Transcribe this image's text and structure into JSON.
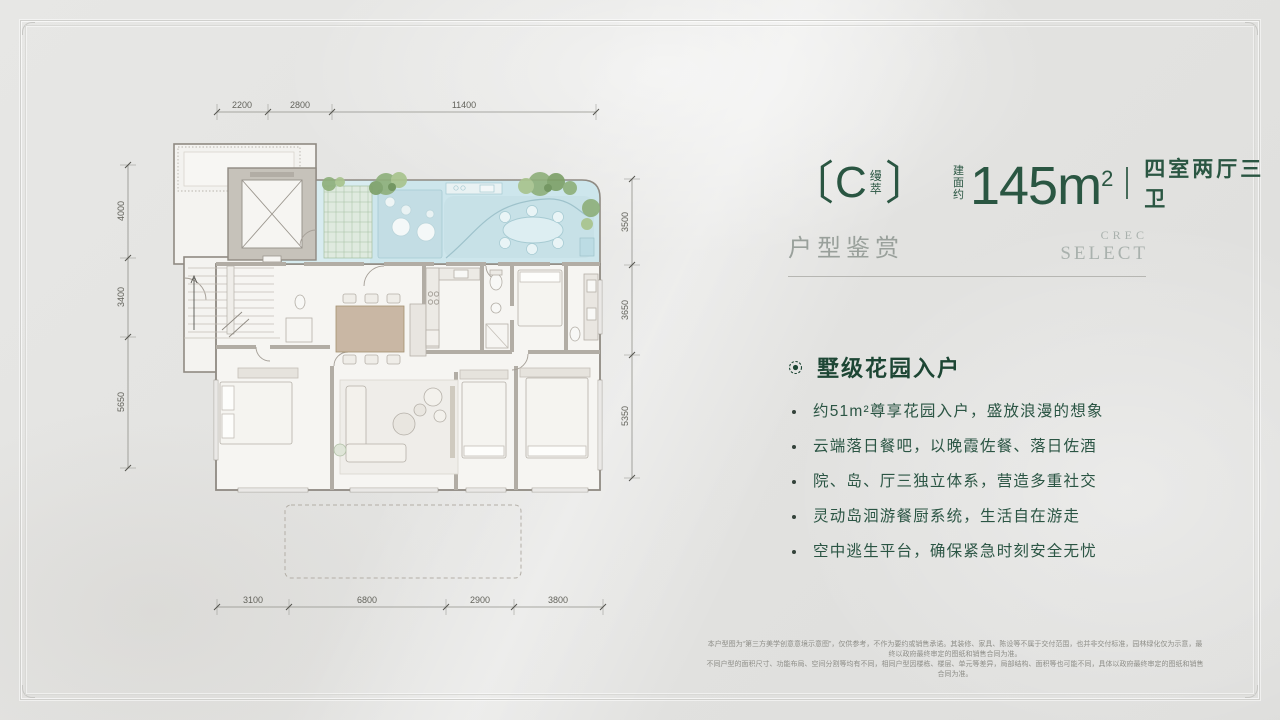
{
  "header": {
    "bracket_open": "〔",
    "unit_letter": "C",
    "unit_name": "缦萃",
    "bracket_close": "〕",
    "area_prefix": "建面约",
    "area_value": "145m",
    "area_exponent": "2",
    "layout_label": "四室两厅三卫"
  },
  "section": {
    "title": "户型鉴赏",
    "brand_line1": "CREC",
    "brand_line2": "SELECT"
  },
  "features": {
    "heading": "墅级花园入户",
    "bullets": [
      "约51m²尊享花园入户，盛放浪漫的想象",
      "云端落日餐吧，以晚霞佐餐、落日佐酒",
      "院、岛、厅三独立体系，营造多重社交",
      "灵动岛洄游餐厨系统，生活自在游走",
      "空中逃生平台，确保紧急时刻安全无忧"
    ]
  },
  "plan": {
    "dims_top": [
      "2200",
      "2800",
      "11400"
    ],
    "dims_left": [
      "4000",
      "3400",
      "5650"
    ],
    "dims_right": [
      "3500",
      "3650",
      "5350"
    ],
    "dims_bottom": [
      "3100",
      "6800",
      "2900",
      "3800"
    ]
  },
  "disclaimer": {
    "line1": "本户型图为“第三方美学创意意境示意图”，仅供参考，不作为要约或销售承诺。其装修、家具、陈设等不属于交付范围，也并非交付标准，园林绿化仅为示意，最终以政府最终审定的图纸和销售合同为准。",
    "line2": "不同户型的面积尺寸、功能布局、空间分割等均有不同，相同户型因楼栋、楼层、单元等差异，局部结构、面积等也可能不同，具体以政府最终审定的图纸和销售合同为准。"
  },
  "colors": {
    "accent_green": "#2a5642",
    "heading_green": "#1d4634",
    "muted_gray": "#99a09b",
    "background": "#e3e3e1"
  }
}
